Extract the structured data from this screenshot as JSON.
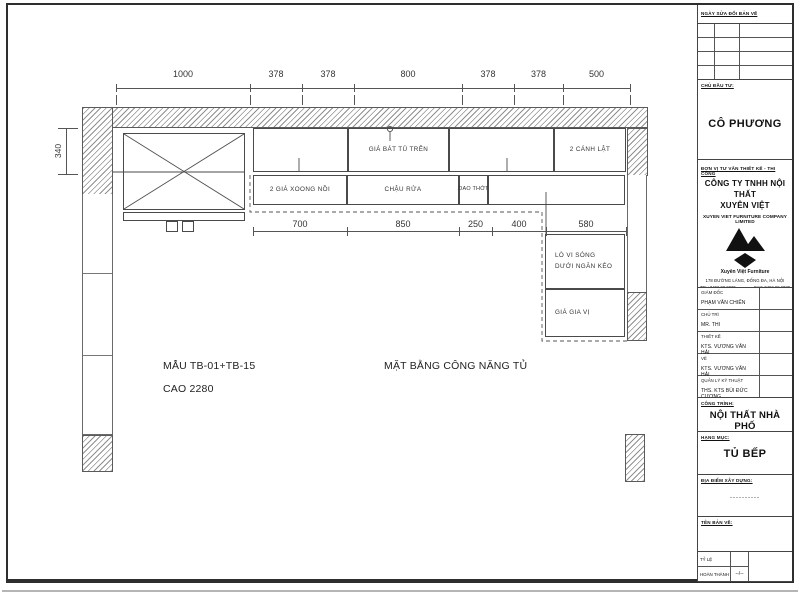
{
  "drawing": {
    "top_dims": [
      "1000",
      "378",
      "378",
      "800",
      "378",
      "378",
      "500"
    ],
    "left_dim": "340",
    "bottom_dims": [
      "700",
      "850",
      "250",
      "400",
      "580"
    ],
    "labels": {
      "gia_bat_tu_tren": "GIÁ BÁT TỦ TRÊN",
      "canh_lat": "2 CÁNH LẬT",
      "xoong_noi": "2 GIÁ XOONG NỒI",
      "chau_rua": "CHẬU RỬA",
      "dao_thot": "DAO THỚT",
      "lo_vi_song_line1": "LÒ VI SÓNG",
      "lo_vi_song_line2": "DƯỚI NGĂN KÉO",
      "gia_gia_vi": "GIÁ GIA VỊ"
    },
    "notes": {
      "model": "MẪU TB-01+TB-15",
      "height": "CAO 2280",
      "plan_title": "MẶT BẰNG CÔNG NĂNG TỦ"
    }
  },
  "title_block": {
    "revision_header": "NGÀY SỬA ĐỔI BẢN VẼ",
    "investor_label": "CHỦ ĐẦU TƯ:",
    "investor_name": "CÔ PHƯƠNG",
    "consultant_label": "ĐƠN VỊ TƯ VẤN THIẾT KẾ - THI CÔNG",
    "company_name_line1": "CÔNG TY TNHH NỘI THẤT",
    "company_name_line2": "XUYÊN VIỆT",
    "company_name_en": "XUYEN VIET FURNITURE COMPANY LIMITED",
    "logo_caption": "Xuyên Việt Furniture",
    "address": "178 ĐƯỜNG LÁNG, ĐỐNG ĐA, HÀ NỘI",
    "tel": "TEL: 0462.99.2020",
    "fax": "FAX: 0462.99.2020",
    "personnel": [
      {
        "label": "GIÁM ĐỐC",
        "name": "PHẠM VĂN CHIẾN"
      },
      {
        "label": "CHỦ TRÌ",
        "name": "MR. THI"
      },
      {
        "label": "THIẾT KẾ",
        "name": "KTS. VƯƠNG VĂN HẢI"
      },
      {
        "label": "VẼ",
        "name": "KTS. VƯƠNG VĂN HẢI"
      },
      {
        "label": "QUẢN LÝ KỸ THUẬT",
        "name": "THS. KTS BÙI ĐỨC CƯƠNG"
      }
    ],
    "project_label": "CÔNG TRÌNH:",
    "project_name": "NỘI THẤT NHÀ PHỐ",
    "category_label": "HẠNG MỤC:",
    "category_name": "TỦ BẾP",
    "location_label": "ĐỊA ĐIỂM XÂY DỰNG:",
    "location_value": "----------",
    "drawing_name_label": "TÊN BẢN VẼ:",
    "scale_label": "TỶ LỆ",
    "completed_label": "HOÀN THÀNH",
    "completed_value": "--/--"
  },
  "colors": {
    "line": "#555555",
    "hatch": "#8f8f8f",
    "text": "#222222"
  }
}
